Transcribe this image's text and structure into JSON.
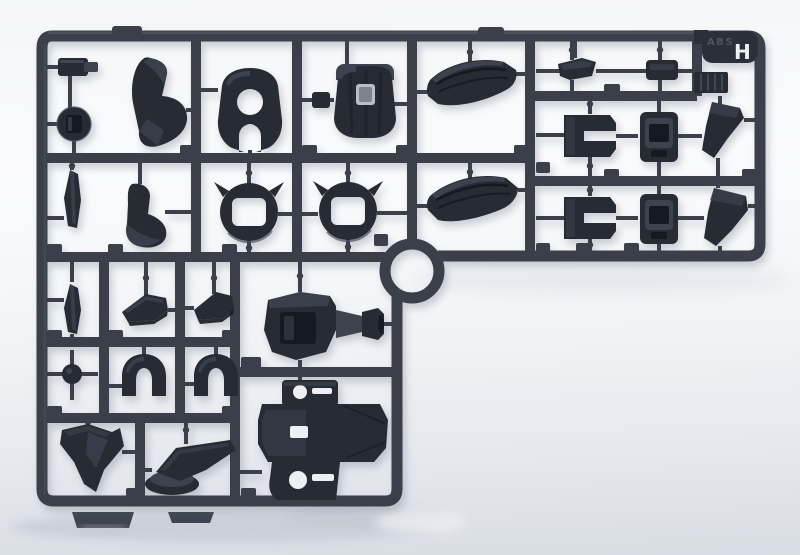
{
  "runner": {
    "tag_letter": "H",
    "material_marking": "ABS",
    "plastic_color_name": "dark gray",
    "colors": {
      "background_top": "#f5f6f8",
      "background_bottom": "#d8dce3",
      "frame": "#3a3f4a",
      "part_dark": "#262b34",
      "part_deep": "#151920",
      "part_mid": "#3c424e",
      "part_light": "#525a68",
      "hole_light": "#edeff3",
      "tag_bg": "#2b2f38",
      "tag_text": "#eef0f4",
      "emboss_text": "#4d535f",
      "shadow": "#b4bbc6",
      "foot": "#3f4550"
    },
    "parts": [
      "latch-clip",
      "round-knob",
      "curved-armor-fin",
      "hooded-cover-with-round-hole",
      "cylinder-drum-joint",
      "curved-skirt-armor-upper",
      "curved-skirt-armor-lower",
      "thin-strip-blade-upper",
      "small-armor-fin",
      "spiked-collar-ring-left",
      "spiked-collar-ring-right",
      "small-cap-left",
      "small-cap-right",
      "c-bracket-upper",
      "hinge-box-upper",
      "angled-shin-blade-upper",
      "c-bracket-lower",
      "hinge-box-lower",
      "angled-shin-blade-lower",
      "thin-strip-blade-lower",
      "wedge-vent-left",
      "wedge-vent-right",
      "joint-ball",
      "arched-guard-left",
      "arched-guard-right",
      "arrow-claw",
      "foot-with-base",
      "backpack-thruster-assembly",
      "torso-core-block"
    ]
  }
}
